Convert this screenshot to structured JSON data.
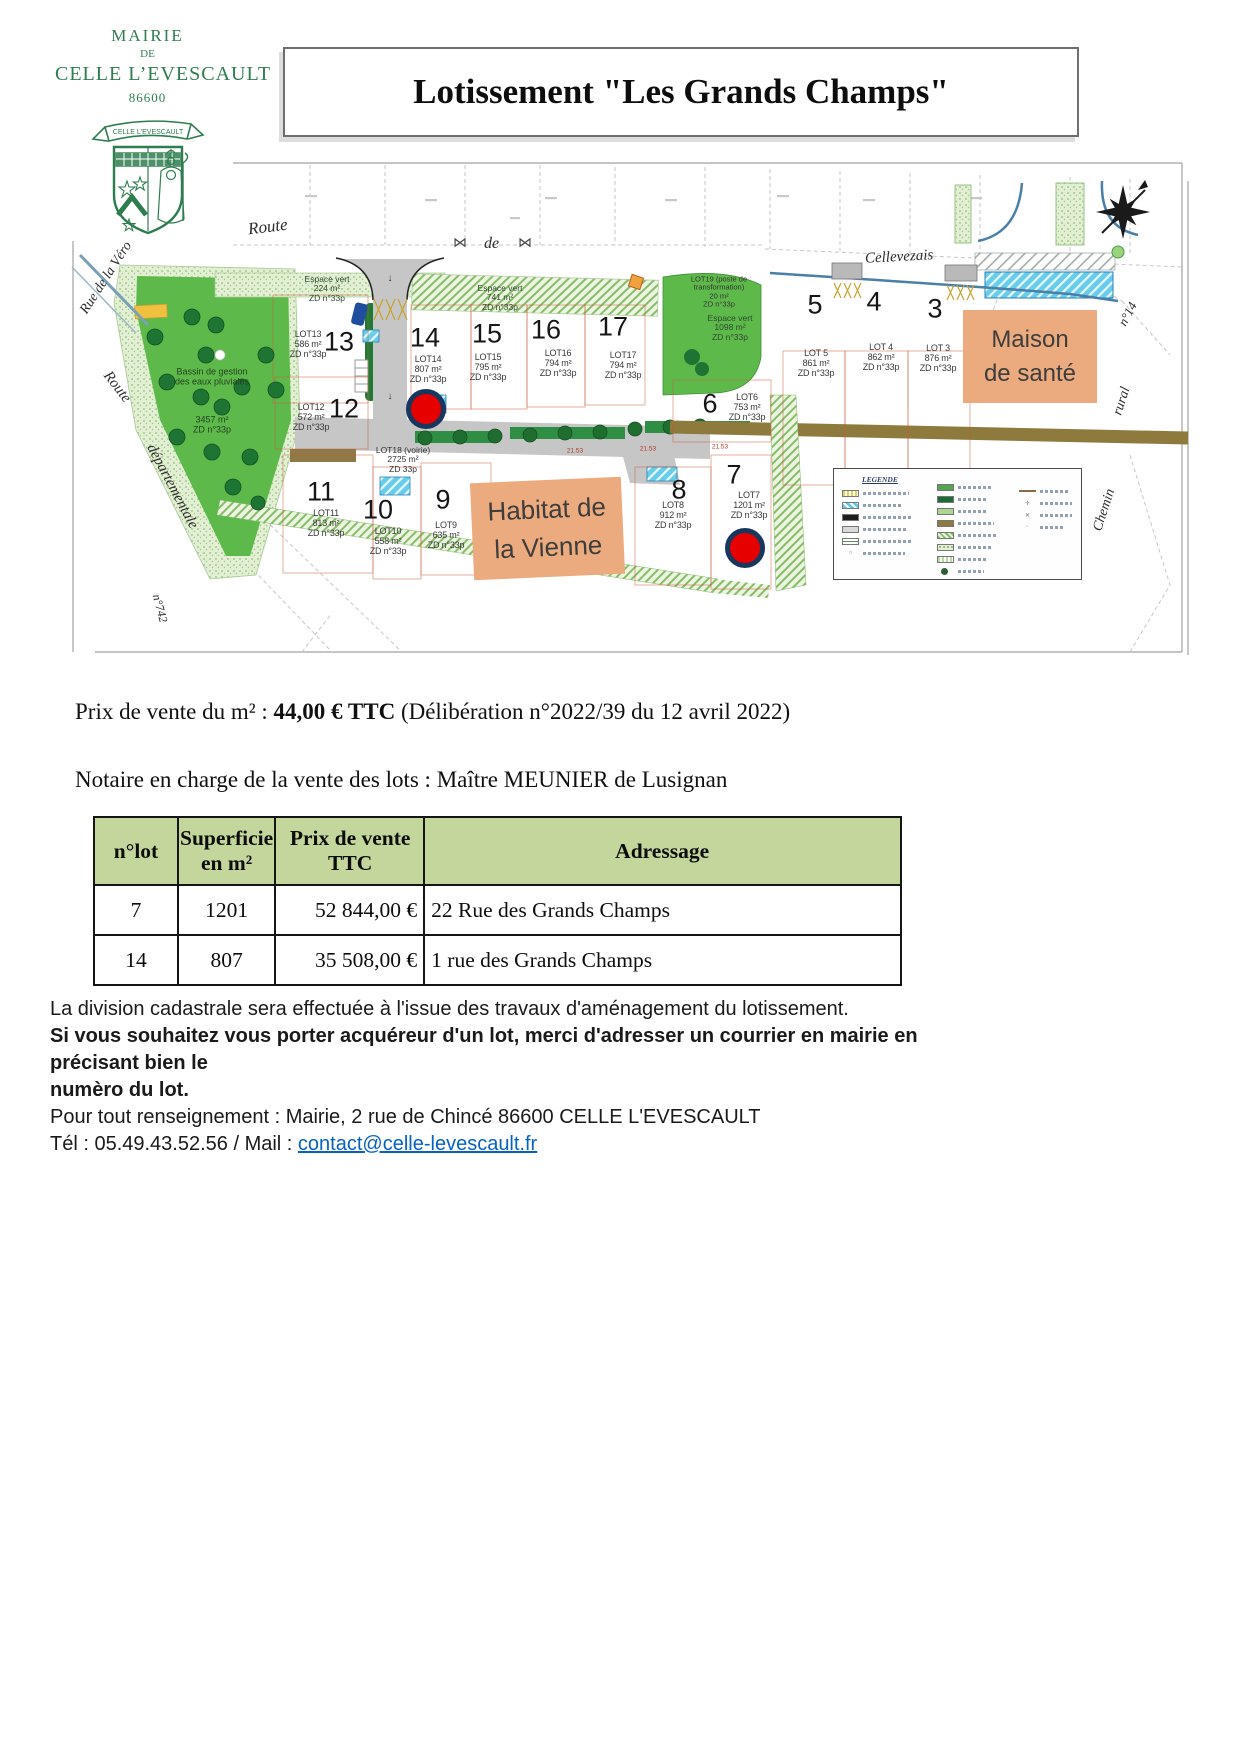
{
  "logo": {
    "line1": "MAIRIE",
    "line2": "DE",
    "line3": "CELLE L’EVESCAULT",
    "line4": "86600",
    "banner": "CELLE L'EVESCAULT"
  },
  "title": "Lotissement \"Les Grands Champs\"",
  "map": {
    "streets": {
      "route": "Route",
      "de": "de",
      "cellevezais": "Cellevezais",
      "rue_vero": "Rue de la Véro",
      "route_left": "Route",
      "departementale": "départementale",
      "n742": "n°742",
      "chemin": "Chemin",
      "rural": "rural",
      "n14": "n°14"
    },
    "bassin": {
      "line1": "Bassin de gestion",
      "line2": "des eaux pluviales",
      "area": "3457 m²",
      "zd": "ZD n°33p"
    },
    "espaces": [
      {
        "name": "Espace vert",
        "area": "224 m²",
        "zd": "ZD n°33p"
      },
      {
        "name": "Espace vert",
        "area": "741 m²",
        "zd": "ZD n°33p"
      },
      {
        "name": "Espace vert",
        "area": "1098 m²",
        "zd": "ZD n°33p"
      }
    ],
    "lot19": {
      "line1": "LOT19 (poste de",
      "line2": "transformation)",
      "area": "20 m²",
      "zd": "ZD n°33p"
    },
    "lot18": {
      "name": "LOT18 (voirie)",
      "area": "2725 m²",
      "zd": "ZD 33p"
    },
    "lots": {
      "3": {
        "name": "LOT 3",
        "area": "876 m²",
        "zd": "ZD n°33p"
      },
      "4": {
        "name": "LOT 4",
        "area": "862 m²",
        "zd": "ZD n°33p"
      },
      "5": {
        "name": "LOT 5",
        "area": "861 m²",
        "zd": "ZD n°33p"
      },
      "6": {
        "name": "LOT6",
        "area": "753 m²",
        "zd": "ZD n°33p"
      },
      "7": {
        "name": "LOT7",
        "area": "1201 m²",
        "zd": "ZD n°33p"
      },
      "8": {
        "name": "LOT8",
        "area": "912 m²",
        "zd": "ZD n°33p"
      },
      "9": {
        "name": "LOT9",
        "area": "635 m²",
        "zd": "ZD n°33p"
      },
      "10": {
        "name": "LOT10",
        "area": "558 m²",
        "zd": "ZD n°33p"
      },
      "11": {
        "name": "LOT11",
        "area": "813 m²",
        "zd": "ZD n°33p"
      },
      "12": {
        "name": "LOT12",
        "area": "572 m²",
        "zd": "ZD n°33p"
      },
      "13": {
        "name": "LOT13",
        "area": "586 m²",
        "zd": "ZD n°33p"
      },
      "14": {
        "name": "LOT14",
        "area": "807 m²",
        "zd": "ZD n°33p"
      },
      "15": {
        "name": "LOT15",
        "area": "795 m²",
        "zd": "ZD n°33p"
      },
      "16": {
        "name": "LOT16",
        "area": "794 m²",
        "zd": "ZD n°33p"
      },
      "17": {
        "name": "LOT17",
        "area": "794 m²",
        "zd": "ZD n°33p"
      }
    },
    "overlays": {
      "maison1": "Maison",
      "maison2": "de santé",
      "habitat1": "Habitat de",
      "habitat2": "la Vienne"
    },
    "legend_title": "LEGENDE",
    "dims": [
      "21.53",
      "21.53",
      "21.53"
    ]
  },
  "pricing": {
    "p1": "Prix de vente du m² : ",
    "p2": "44,00 € TTC",
    "p3": " (Délibération n°2022/39 du 12 avril 2022)"
  },
  "notaire": "Notaire en charge de la vente des lots : Maître MEUNIER de Lusignan",
  "table": {
    "headers": [
      "n°lot",
      "Superficie en m²",
      "Prix de vente TTC",
      "Adressage"
    ],
    "rows": [
      [
        "7",
        "1201",
        "52 844,00 €",
        "22 Rue des Grands Champs"
      ],
      [
        "14",
        "807",
        "35 508,00 €",
        "1 rue des Grands Champs"
      ]
    ]
  },
  "footer": {
    "line1": "La division cadastrale sera effectuée à l'issue des travaux d'aménagement du lotissement.",
    "line2a": "Si vous souhaitez vous porter acquéreur d'un lot, merci d'adresser un courrier en mairie en précisant bien le",
    "line2b": "numèro du lot.",
    "line3": "Pour tout renseignement : Mairie, 2 rue de Chincé 86600 CELLE L'EVESCAULT",
    "tel": "Tél : 05.49.43.52.56  / Mail : ",
    "mail": "contact@celle-levescault.fr"
  },
  "colors": {
    "logo_green": "#2e7d4f",
    "table_header_green": "#c3d69b",
    "overlay_orange": "#ecab7e",
    "marker_red": "#e60000",
    "marker_ring": "#17375e",
    "link_blue": "#0563c1",
    "park_green": "#5eb94b"
  }
}
